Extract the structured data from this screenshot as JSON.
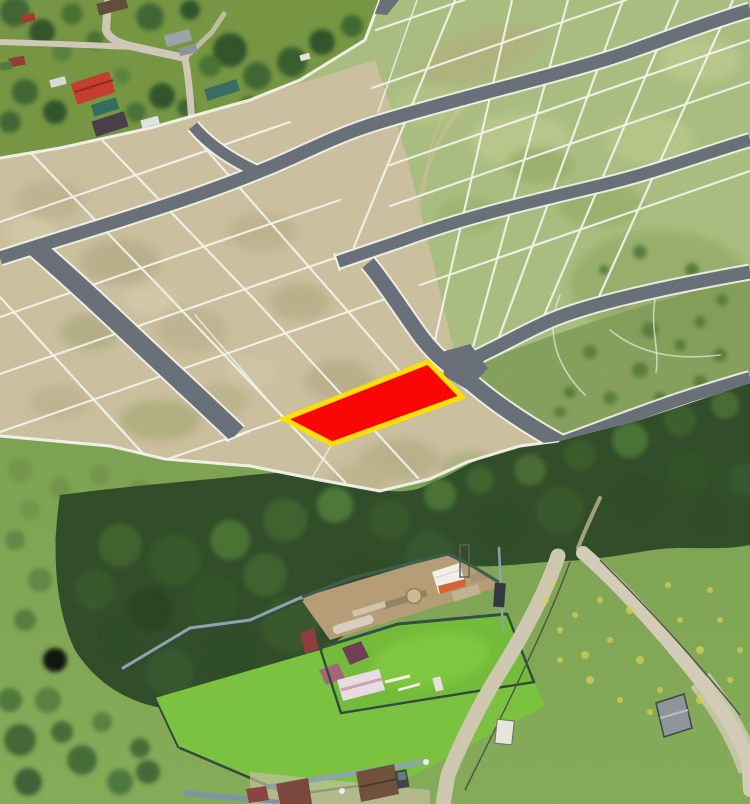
{
  "page": {
    "kind": "aerial-photo-with-cadastral-overlay",
    "width": 750,
    "height": 804
  },
  "colors": {
    "highlight_red": "#fd0000",
    "highlight_border_yellow": "#ffe100",
    "road_gray": "#666d76",
    "plot_line_white": "#f3f5ec",
    "field_tan": "#cbbf9d",
    "field_green": "#a9bd7e",
    "village_green": "#74953f",
    "forest_green": "#2c4a24",
    "meadow_green": "#7ea452",
    "lawn_green": "#72bb35",
    "dirt_road": "#cfc8b0",
    "fence_blue": "#8ba3ae",
    "pond_dark": "#333f2b",
    "red_roof": "#c63a28",
    "teal_roof": "#2f6b5e"
  },
  "highlighted_plot": {
    "fill": "#fd0000",
    "border": "#ffe100",
    "shape": "parallelogram"
  }
}
